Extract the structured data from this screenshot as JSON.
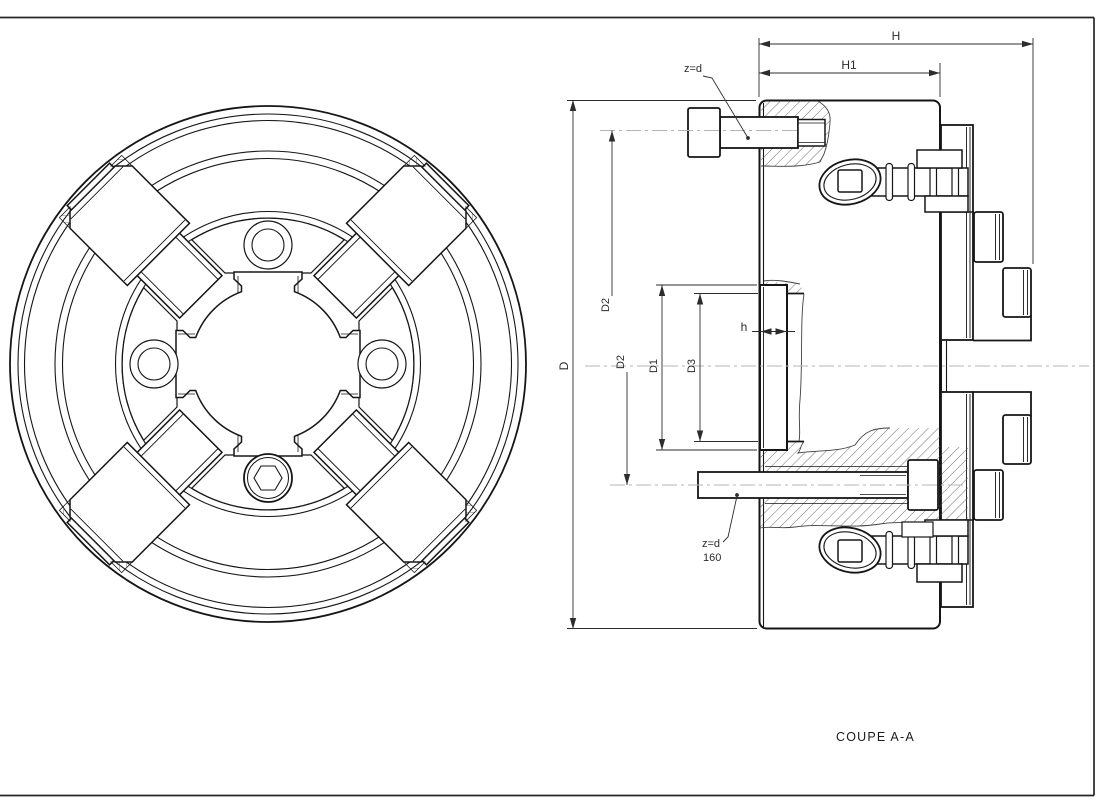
{
  "drawing": {
    "caption": "COUPE A-A",
    "dim_labels": {
      "H": "H",
      "H1": "H1",
      "D": "D",
      "D1": "D1",
      "D2_upper": "D2",
      "D2_lower": "D2",
      "D3": "D3",
      "h": "h"
    },
    "leaders": {
      "top": "z=d",
      "bottom_line1": "z=d",
      "bottom_line2": "160"
    }
  },
  "colors": {
    "background": "#ffffff",
    "line": "#161616",
    "dim": "#2c2c2c",
    "centerline": "#b4b4b4",
    "hatch": "#4c4c4c",
    "frame": "#262626"
  }
}
